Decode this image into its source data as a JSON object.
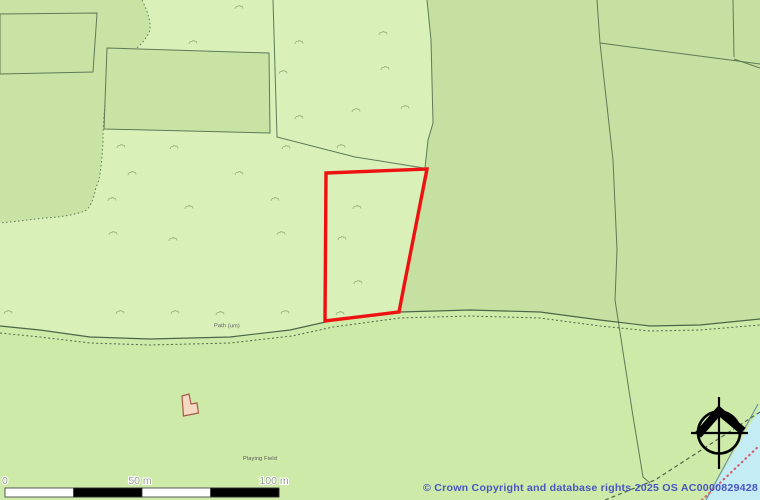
{
  "labels": {
    "path": "Path (um)",
    "playing_field": "Playing Field"
  },
  "scale_bar": {
    "zero": "0",
    "fifty": "50 m",
    "hundred": "100 m"
  },
  "copyright": "© Crown Copyright and database rights 2025 OS AC0000829428",
  "icons": {
    "compass": "compass-rose-north-icon"
  },
  "colors": {
    "pale_field": "#d9f0b8",
    "woodland": "#c9e3a4",
    "right_field": "#c5e0a0",
    "bottom_field": "#cdeaa9",
    "sliver_field": "#def3c0",
    "water": "#c3ecf4",
    "shoreline": "#6d95a4",
    "boundary_line": "#5f7a55",
    "path_line": "#4d6647",
    "red_boundary": "#ee1111",
    "red_dots": "#d4626e",
    "building_fill": "#f6d9c2",
    "building_outline": "#a85848",
    "tree_symbol": "#a3b887",
    "map_label": "#555555",
    "scale_label": "#999e94",
    "scale_black": "#000000",
    "compass": "#000000",
    "copyright_text": "#4a55c2"
  }
}
